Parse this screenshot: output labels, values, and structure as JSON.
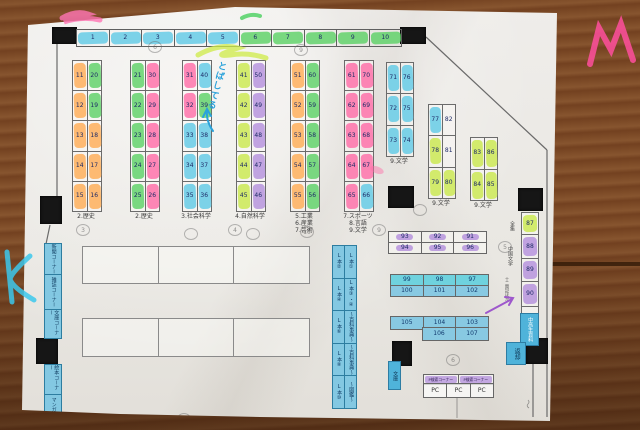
{
  "palette": {
    "wood": "#7d4b27",
    "paper": "#ecebe6",
    "line": "#6b6b6b",
    "pillar": "#161616",
    "number_ink": "#1d2a66",
    "hl_cyan": "#5ec9e6",
    "hl_green": "#5ad164",
    "hl_orange": "#ffab52",
    "hl_pink": "#ff6aa6",
    "hl_yellowgreen": "#c9e94b",
    "hl_purple": "#b38fdc",
    "table_blue": "#88c9e2",
    "table_cyan": "#6fd2de",
    "print_blue": "#83c8e2",
    "print_blue_dark": "#4fb3da"
  },
  "top_row": {
    "cells": [
      "1",
      "2",
      "3",
      "4",
      "5",
      "6",
      "7",
      "8",
      "9",
      "10"
    ]
  },
  "shelf_columns": [
    {
      "label_lines": [
        "2.歴史"
      ],
      "rows": [
        [
          "11",
          "20"
        ],
        [
          "12",
          "19"
        ],
        [
          "13",
          "18"
        ],
        [
          "14",
          "17"
        ],
        [
          "15",
          "16"
        ]
      ],
      "hl": [
        [
          "orange",
          "green"
        ],
        [
          "orange",
          "green"
        ],
        [
          "orange",
          "orange"
        ],
        [
          "orange",
          "orange"
        ],
        [
          "orange",
          "orange"
        ]
      ]
    },
    {
      "label_lines": [
        "2.歴史"
      ],
      "rows": [
        [
          "21",
          "30"
        ],
        [
          "22",
          "29"
        ],
        [
          "23",
          "28"
        ],
        [
          "24",
          "27"
        ],
        [
          "25",
          "26"
        ]
      ],
      "hl": [
        [
          "green",
          "pink"
        ],
        [
          "green",
          "pink"
        ],
        [
          "green",
          "pink"
        ],
        [
          "green",
          "pink"
        ],
        [
          "green",
          "pink"
        ]
      ]
    },
    {
      "label_lines": [
        "3.社会科学"
      ],
      "rows": [
        [
          "31",
          "40"
        ],
        [
          "32",
          "39"
        ],
        [
          "33",
          "38"
        ],
        [
          "34",
          "37"
        ],
        [
          "35",
          "36"
        ]
      ],
      "hl": [
        [
          "pink",
          "cyan"
        ],
        [
          "pink",
          "green"
        ],
        [
          "cyan",
          "cyan"
        ],
        [
          "cyan",
          "cyan"
        ],
        [
          "cyan",
          "cyan"
        ]
      ]
    },
    {
      "label_lines": [
        "4.自然科学"
      ],
      "rows": [
        [
          "41",
          "50"
        ],
        [
          "42",
          "49"
        ],
        [
          "43",
          "48"
        ],
        [
          "44",
          "47"
        ],
        [
          "45",
          "46"
        ]
      ],
      "hl": [
        [
          "yellowgreen",
          "purple"
        ],
        [
          "yellowgreen",
          "purple"
        ],
        [
          "yellowgreen",
          "purple"
        ],
        [
          "yellowgreen",
          "purple"
        ],
        [
          "yellowgreen",
          "purple"
        ]
      ]
    },
    {
      "label_lines": [
        "5.工業",
        "6.産業",
        "7.芸術"
      ],
      "rows": [
        [
          "51",
          "60"
        ],
        [
          "52",
          "59"
        ],
        [
          "53",
          "58"
        ],
        [
          "54",
          "57"
        ],
        [
          "55",
          "56"
        ]
      ],
      "hl": [
        [
          "orange",
          "green"
        ],
        [
          "orange",
          "green"
        ],
        [
          "orange",
          "green"
        ],
        [
          "orange",
          "green"
        ],
        [
          "orange",
          "green"
        ]
      ]
    },
    {
      "label_lines": [
        "7.スポーツ",
        "8.言語",
        "9.文学"
      ],
      "rows": [
        [
          "61",
          "70"
        ],
        [
          "62",
          "69"
        ],
        [
          "63",
          "68"
        ],
        [
          "64",
          "67"
        ],
        [
          "65",
          "66"
        ]
      ],
      "hl": [
        [
          "pink",
          "pink"
        ],
        [
          "pink",
          "pink"
        ],
        [
          "pink",
          "pink"
        ],
        [
          "pink",
          "pink"
        ],
        [
          "pink",
          "cyan"
        ]
      ]
    }
  ],
  "right_columns": [
    {
      "label": "9.文学",
      "rows": [
        [
          "71",
          "76"
        ],
        [
          "72",
          "75"
        ],
        [
          "73",
          "74"
        ]
      ],
      "hl": [
        [
          "cyan",
          "cyan"
        ],
        [
          "cyan",
          "cyan"
        ],
        [
          "cyan",
          "cyan"
        ]
      ]
    },
    {
      "label": "9.文学",
      "rows": [
        [
          "77",
          "82"
        ],
        [
          "78",
          "81"
        ],
        [
          "79",
          "80"
        ]
      ],
      "hl": [
        [
          "cyan",
          "none"
        ],
        [
          "yellowgreen",
          "none"
        ],
        [
          "yellowgreen",
          "yellowgreen"
        ]
      ]
    },
    {
      "label": "9.文学",
      "rows": [
        [
          "83",
          "86"
        ],
        [
          "84",
          "85"
        ]
      ],
      "hl": [
        [
          "yellowgreen",
          "yellowgreen"
        ],
        [
          "yellowgreen",
          "yellowgreen"
        ]
      ]
    }
  ],
  "wall_shelf": {
    "cells": [
      {
        "n": "87",
        "hl": "yellowgreen"
      },
      {
        "n": "88",
        "hl": "purple"
      },
      {
        "n": "89",
        "hl": "purple"
      },
      {
        "n": "90",
        "hl": "purple"
      }
    ],
    "side_labels": [
      "全集",
      "中国文学",
      "十二国記ほか"
    ],
    "strip_label": "中高生資料",
    "return_label": "返却"
  },
  "tables": {
    "purple": [
      [
        "93",
        "92",
        "91"
      ],
      [
        "94",
        "95",
        "96"
      ]
    ],
    "blue_a": [
      [
        "99",
        "98",
        "97"
      ],
      [
        "100",
        "101",
        "102"
      ]
    ],
    "blue_b_row1": [
      "105",
      "104",
      "103"
    ],
    "blue_b_row2": [
      "106",
      "107"
    ]
  },
  "pc_corner": {
    "headers": [
      "P検索コーナー",
      "P検索コーナー"
    ],
    "pcs": [
      "PC",
      "PC",
      "PC"
    ],
    "tag": "文庫"
  },
  "lbook_strip": {
    "left": [
      "L本②",
      "L本④",
      "L本⑥",
      "L本⑧",
      "L本⑩"
    ],
    "right": [
      "L本①",
      "L本③・④",
      "〜百科事典〜",
      "〜百科事典〜",
      "〜図鑑〜"
    ]
  },
  "left_wall_strip": [
    "新聞コーナー",
    "雑誌コーナー",
    "文庫コーナー",
    "絵本コーナー",
    "マンガ"
  ],
  "annotations": {
    "blue_note": "とばしてる",
    "pencil_marks": [
      "6",
      "9",
      "3",
      "4",
      "",
      "",
      "9",
      "",
      "5",
      "6",
      "",
      "10"
    ]
  }
}
